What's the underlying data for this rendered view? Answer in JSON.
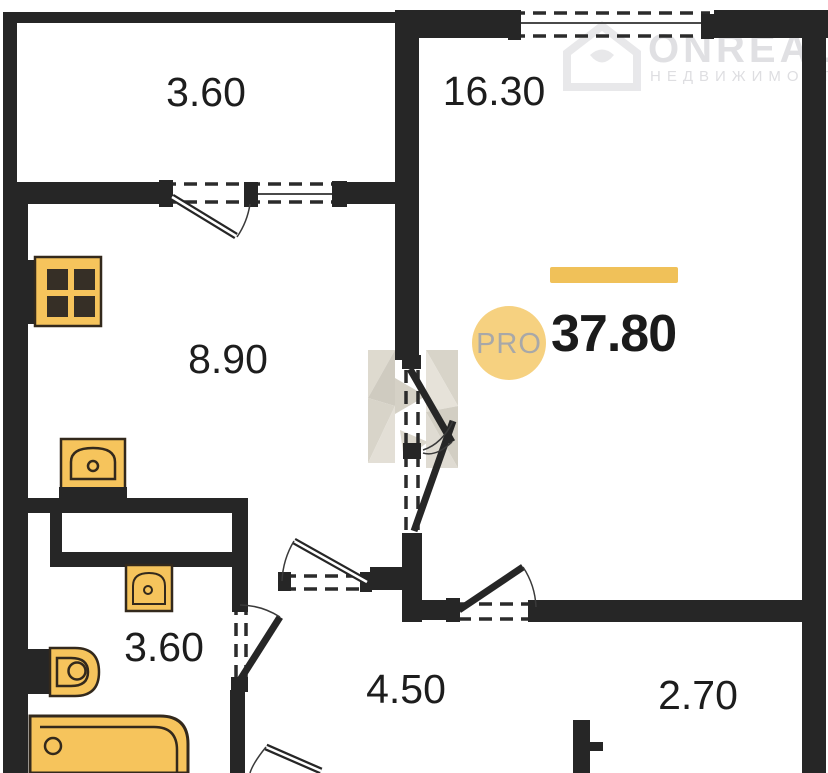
{
  "watermark": {
    "brand": "ONREALT",
    "subtitle": "НЕДВИЖИМОСТЬ"
  },
  "plan": {
    "total_area": "37.80",
    "badge_label": "PRO",
    "rooms": {
      "balcony": "3.60",
      "living": "16.30",
      "kitchen": "8.90",
      "bathroom": "3.60",
      "hallway": "4.50",
      "wardrobe": "2.70"
    }
  },
  "colors": {
    "wall": "#262626",
    "fixture-fill": "#f6c45c",
    "fixture-stroke": "#33291c",
    "accent-bar": "#f0c159",
    "badge-fill": "#f6d180",
    "badge-text": "#a8a8a8",
    "label-text": "#1d1d1d",
    "watermark": "#d6d6da"
  }
}
